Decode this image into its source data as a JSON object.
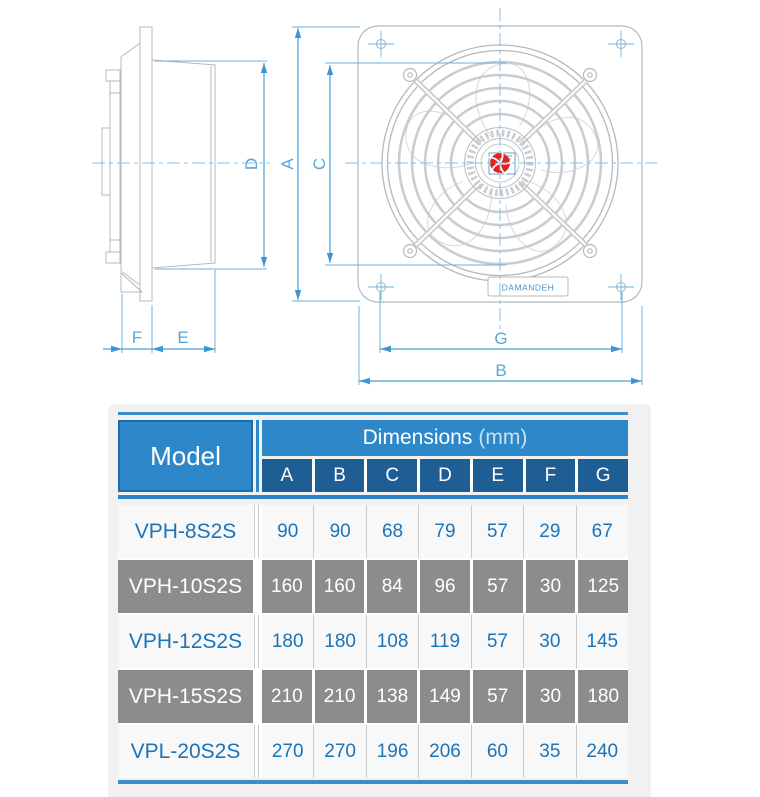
{
  "diagram": {
    "dimension_labels": {
      "A": "A",
      "B": "B",
      "C": "C",
      "D": "D",
      "E": "E",
      "F": "F",
      "G": "G"
    },
    "brand_plate_text": "DAMANDEH",
    "colors": {
      "dimension_blue": "#4aa0d8",
      "drawing_gray": "#b4b9bc",
      "hub_red": "#e8211d",
      "centerline_blue": "#85c2e8"
    }
  },
  "table": {
    "header": {
      "model_label": "Model",
      "dimensions_label": "Dimensions",
      "unit_label": "(mm)",
      "columns": [
        "A",
        "B",
        "C",
        "D",
        "E",
        "F",
        "G"
      ]
    },
    "rows": [
      {
        "model": "VPH-8S2S",
        "values": [
          "90",
          "90",
          "68",
          "79",
          "57",
          "29",
          "67"
        ]
      },
      {
        "model": "VPH-10S2S",
        "values": [
          "160",
          "160",
          "84",
          "96",
          "57",
          "30",
          "125"
        ]
      },
      {
        "model": "VPH-12S2S",
        "values": [
          "180",
          "180",
          "108",
          "119",
          "57",
          "30",
          "145"
        ]
      },
      {
        "model": "VPH-15S2S",
        "values": [
          "210",
          "210",
          "138",
          "149",
          "57",
          "30",
          "180"
        ]
      },
      {
        "model": "VPL-20S2S",
        "values": [
          "270",
          "270",
          "196",
          "206",
          "60",
          "35",
          "240"
        ]
      }
    ]
  }
}
